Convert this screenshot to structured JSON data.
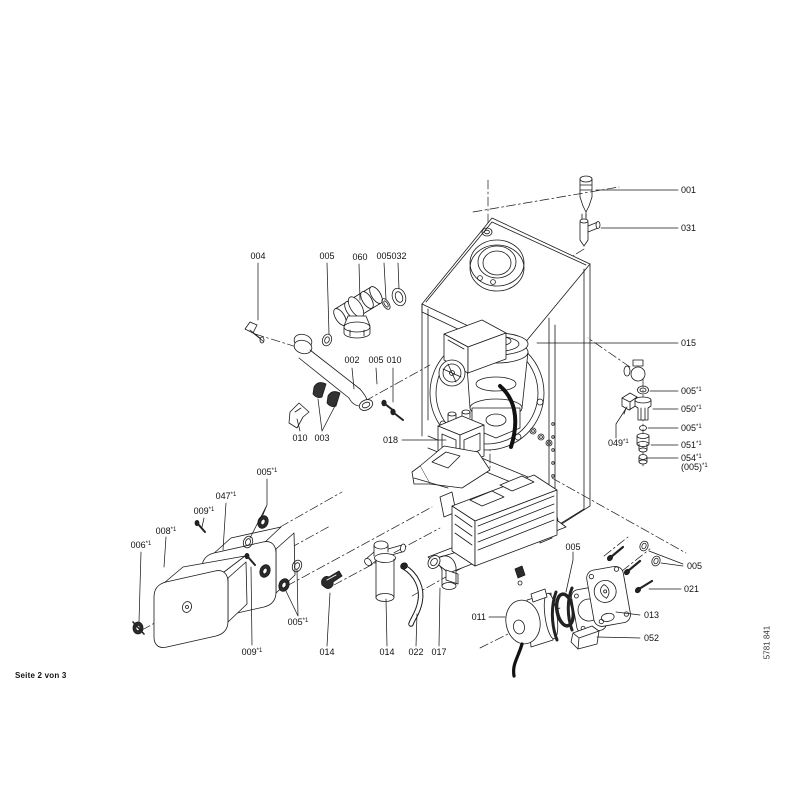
{
  "document": {
    "kind": "boiler-exploded-parts-diagram",
    "footer": {
      "page_indicator": "Seite 2 von 3",
      "doc_number": "5781 841"
    }
  },
  "colors": {
    "background": "#ffffff",
    "line": "#1a1a1a",
    "label_text": "#111111",
    "dark_fill": "#2b2b2b"
  },
  "labels": [
    {
      "id": "001",
      "text": "001",
      "x": 681,
      "y": 193,
      "anchor": "start"
    },
    {
      "id": "031",
      "text": "031",
      "x": 681,
      "y": 231,
      "anchor": "start"
    },
    {
      "id": "015",
      "text": "015",
      "x": 681,
      "y": 346,
      "anchor": "start"
    },
    {
      "id": "005-r1",
      "text": "005",
      "sup": "*1",
      "x": 681,
      "y": 394,
      "anchor": "start"
    },
    {
      "id": "050",
      "text": "050",
      "sup": "*1",
      "x": 681,
      "y": 412,
      "anchor": "start"
    },
    {
      "id": "005-r2",
      "text": "005",
      "sup": "*1",
      "x": 681,
      "y": 431,
      "anchor": "start"
    },
    {
      "id": "051",
      "text": "051",
      "sup": "*1",
      "x": 681,
      "y": 448,
      "anchor": "start"
    },
    {
      "id": "054",
      "text": "054",
      "sup": "*1",
      "x": 681,
      "y": 461,
      "anchor": "start"
    },
    {
      "id": "005-paren",
      "text": "(005)",
      "sup": "*1",
      "x": 681,
      "y": 470,
      "anchor": "start"
    },
    {
      "id": "049",
      "text": "049",
      "sup": "*1",
      "x": 608,
      "y": 446,
      "anchor": "start"
    },
    {
      "id": "005-screws",
      "text": "005",
      "x": 687,
      "y": 569,
      "anchor": "start"
    },
    {
      "id": "021",
      "text": "021",
      "x": 684,
      "y": 592,
      "anchor": "start"
    },
    {
      "id": "013",
      "text": "013",
      "x": 644,
      "y": 618,
      "anchor": "start"
    },
    {
      "id": "052",
      "text": "052",
      "x": 644,
      "y": 641,
      "anchor": "start"
    },
    {
      "id": "018",
      "text": "018",
      "x": 398,
      "y": 443,
      "anchor": "end"
    },
    {
      "id": "011",
      "text": "011",
      "x": 486,
      "y": 620,
      "anchor": "end"
    },
    {
      "id": "004",
      "text": "004",
      "x": 258,
      "y": 259,
      "anchor": "middle"
    },
    {
      "id": "005-top1",
      "text": "005",
      "x": 327,
      "y": 259,
      "anchor": "middle"
    },
    {
      "id": "060",
      "text": "060",
      "x": 360,
      "y": 260,
      "anchor": "middle"
    },
    {
      "id": "005-top2",
      "text": "005",
      "x": 384,
      "y": 259,
      "anchor": "middle"
    },
    {
      "id": "032",
      "text": "032",
      "x": 399,
      "y": 259,
      "anchor": "middle"
    },
    {
      "id": "002",
      "text": "002",
      "x": 352,
      "y": 363,
      "anchor": "middle"
    },
    {
      "id": "005-mid",
      "text": "005",
      "x": 376,
      "y": 363,
      "anchor": "middle"
    },
    {
      "id": "010-mid",
      "text": "010",
      "x": 394,
      "y": 363,
      "anchor": "middle"
    },
    {
      "id": "010-left",
      "text": "010",
      "x": 300,
      "y": 441,
      "anchor": "middle"
    },
    {
      "id": "003",
      "text": "003",
      "x": 322,
      "y": 441,
      "anchor": "middle"
    },
    {
      "id": "005-ll-top",
      "text": "005",
      "sup": "*1",
      "x": 267,
      "y": 475,
      "anchor": "middle"
    },
    {
      "id": "047",
      "text": "047",
      "sup": "*1",
      "x": 226,
      "y": 499,
      "anchor": "middle"
    },
    {
      "id": "009-top",
      "text": "009",
      "sup": "*1",
      "x": 204,
      "y": 514,
      "anchor": "middle"
    },
    {
      "id": "008",
      "text": "008",
      "sup": "*1",
      "x": 166,
      "y": 534,
      "anchor": "middle"
    },
    {
      "id": "006",
      "text": "006",
      "sup": "*1",
      "x": 141,
      "y": 548,
      "anchor": "middle"
    },
    {
      "id": "009-bottom",
      "text": "009",
      "sup": "*1",
      "x": 252,
      "y": 655,
      "anchor": "middle"
    },
    {
      "id": "005-ll-right",
      "text": "005",
      "sup": "*1",
      "x": 298,
      "y": 625,
      "anchor": "middle"
    },
    {
      "id": "014-clip",
      "text": "014",
      "x": 327,
      "y": 655,
      "anchor": "middle"
    },
    {
      "id": "014-trap",
      "text": "014",
      "x": 387,
      "y": 655,
      "anchor": "middle"
    },
    {
      "id": "022",
      "text": "022",
      "x": 416,
      "y": 655,
      "anchor": "middle"
    },
    {
      "id": "017",
      "text": "017",
      "x": 439,
      "y": 655,
      "anchor": "middle"
    },
    {
      "id": "005-pump",
      "text": "005",
      "x": 573,
      "y": 550,
      "anchor": "middle"
    }
  ]
}
